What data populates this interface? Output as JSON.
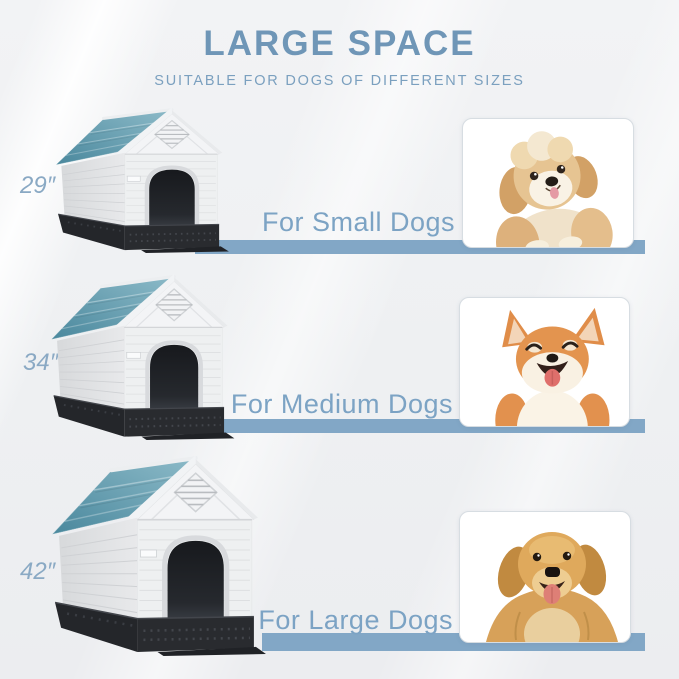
{
  "page": {
    "title": "LARGE SPACE",
    "subtitle": "SUITABLE FOR DOGS OF DIFFERENT SIZES"
  },
  "rows": [
    {
      "size_label": "29″",
      "caption": "For Small Dogs",
      "house_image": "small-blue-roof-dog-house",
      "photo_image": "fluffy-havanese-puppy"
    },
    {
      "size_label": "34″",
      "caption": "For Medium Dogs",
      "house_image": "medium-blue-roof-dog-house",
      "photo_image": "smiling-shiba-inu"
    },
    {
      "size_label": "42″",
      "caption": "For Large Dogs",
      "house_image": "large-blue-roof-dog-house",
      "photo_image": "golden-retriever"
    }
  ],
  "colors": {
    "title_blue": "#6f96b7",
    "subtitle_blue": "#7ba0bf",
    "caption_blue": "#7ca3c4",
    "size_label_blue": "#8aa9c4",
    "bar_blue": "#82a7c6",
    "roof_teal": "#5f9cae",
    "house_wall": "#eef0f1",
    "house_base": "#26282c",
    "background": "#f0f1f3"
  }
}
